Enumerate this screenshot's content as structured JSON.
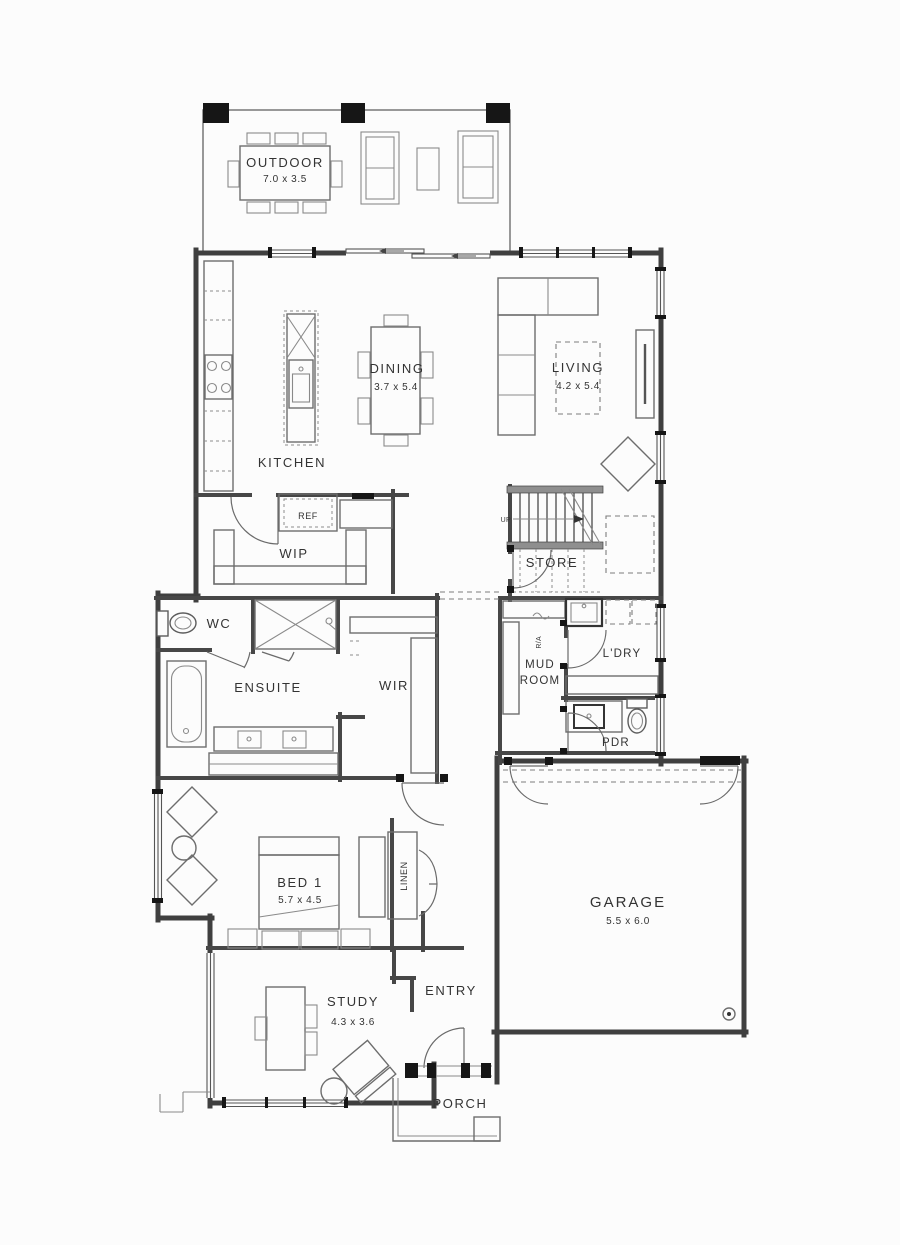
{
  "plan": {
    "title": "single-storey house floor plan",
    "rooms": {
      "outdoor": {
        "name": "OUTDOOR",
        "dims": "7.0 x 3.5"
      },
      "kitchen": {
        "name": "KITCHEN"
      },
      "dining": {
        "name": "DINING",
        "dims": "3.7 x 5.4"
      },
      "living": {
        "name": "LIVING",
        "dims": "4.2 x 5.4"
      },
      "ref": {
        "name": "REF"
      },
      "wip": {
        "name": "WIP"
      },
      "store": {
        "name": "STORE"
      },
      "stairs": {
        "up": "UP"
      },
      "wc": {
        "name": "WC"
      },
      "ensuite": {
        "name": "ENSUITE"
      },
      "wir": {
        "name": "WIR"
      },
      "mudroom": {
        "line1": "MUD",
        "line2": "ROOM"
      },
      "ra": {
        "name": "R/A"
      },
      "ldry": {
        "name": "L'DRY"
      },
      "pdr": {
        "name": "PDR"
      },
      "bed1": {
        "name": "BED 1",
        "dims": "5.7 x 4.5"
      },
      "linen": {
        "name": "LINEN"
      },
      "entry": {
        "name": "ENTRY"
      },
      "garage": {
        "name": "GARAGE",
        "dims": "5.5 x 6.0"
      },
      "study": {
        "name": "STUDY",
        "dims": "4.3 x 3.6"
      },
      "porch": {
        "name": "PORCH"
      }
    },
    "colors": {
      "wall": "#3f3f3f",
      "furniture_line": "#6d6d6d",
      "text": "#333333",
      "column": "#161616",
      "stair_landing": "#8f8f8f",
      "background": "#fcfcfc"
    }
  }
}
